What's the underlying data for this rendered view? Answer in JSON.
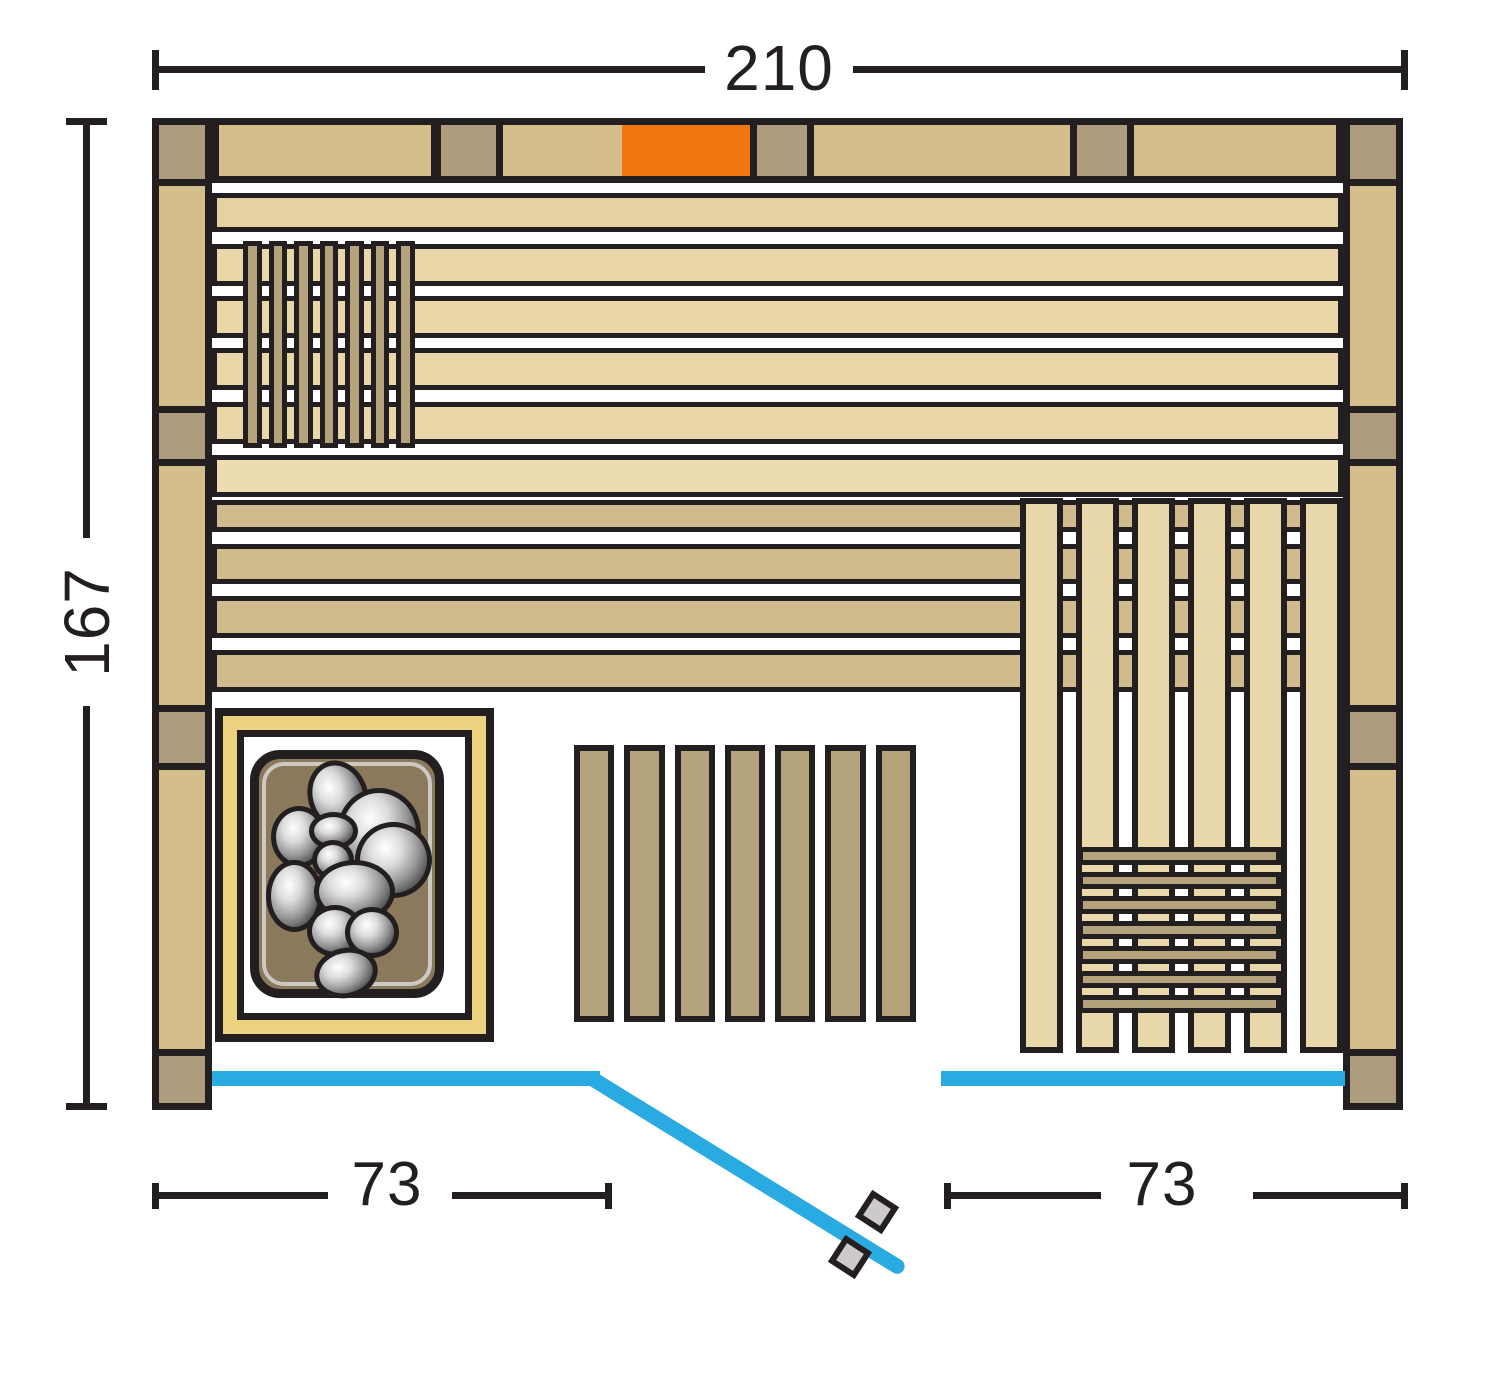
{
  "diagram": {
    "kind": "sauna floor plan, top view",
    "dimensions": {
      "width_label": "210",
      "height_label": "167",
      "front_left_label": "73",
      "front_right_label": "73"
    },
    "components": [
      "back-wall",
      "left-wall",
      "right-wall",
      "corner-posts",
      "upper-bench-planks",
      "lower-bench-planks",
      "headrest",
      "heater-with-stones",
      "floor-grate",
      "right-bench-slats",
      "bench-grate",
      "glass-front",
      "glass-door",
      "door-handle"
    ]
  },
  "colors": {
    "outline": "#231f20",
    "wood_tan": "#d3bd8a",
    "wood_grey": "#ae9d7c",
    "plank_top": "#e4d2a4",
    "plank_cream": "#e9d7aa",
    "plank_cream_light": "#ecdcb2",
    "plank_dark": "#cfbb8e",
    "slat_dark": "#b5a37d",
    "slat_cream": "#e9d8ab",
    "grate": "#b3a27c",
    "accent_orange": "#ef760e",
    "heater_frame": "#ecd17f",
    "heater_body": "#8a795a",
    "heater_ring": "#ccc9c3",
    "glass_blue": "#29abe2",
    "handle_grey": "#cccbc9"
  }
}
